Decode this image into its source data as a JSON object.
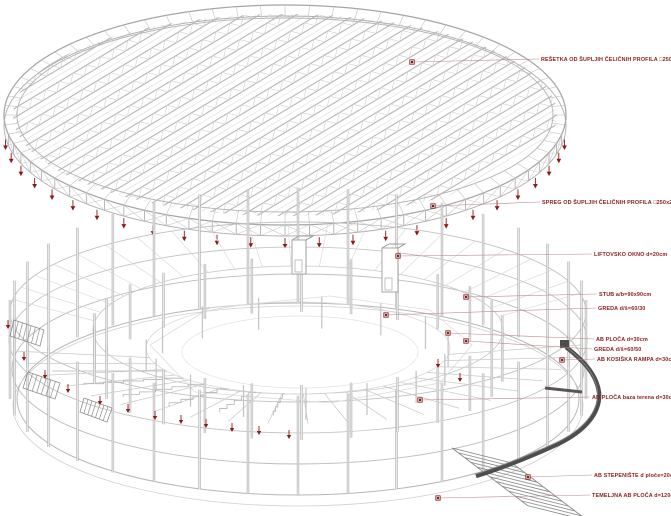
{
  "figure": {
    "type": "structural-axonometric-diagram",
    "subject": "stadium exploded structural view",
    "upper_part": "steel roof truss grid (elliptical)",
    "lower_part": "reinforced concrete stadium bowl frame"
  },
  "colors": {
    "background": "#ffffff",
    "line_light": "#d2d2d2",
    "line_mid": "#b9b9b9",
    "line_rim": "#a5a5a5",
    "line_col": "#aaaaaa",
    "annotation_red": "#8b1a1a",
    "marker_fill": "#f0dada",
    "ramp_dark": "#4d4d4d",
    "stair_gray": "#9b9b9b",
    "hatch_gray": "#8e8e8e"
  },
  "annotations": [
    {
      "id": "resetka",
      "text": "REŠETKA OD ŠUPLJIH ČELIČNIH PROFILA □250x250mm",
      "label_x": 541,
      "label_y": 61,
      "marker_x": 412,
      "marker_y": 62
    },
    {
      "id": "spreg",
      "text": "SPREG OD ŠUPLJIH ČELIČNIH PROFILA □250x250mm",
      "label_x": 542,
      "label_y": 204,
      "marker_x": 433,
      "marker_y": 206
    },
    {
      "id": "liftovsko-okno",
      "text": "LIFTOVSKO OKNO d=20cm",
      "label_x": 594,
      "label_y": 256,
      "marker_x": 398,
      "marker_y": 256
    },
    {
      "id": "stub",
      "text": "STUB a/b=90x90cm",
      "label_x": 599,
      "label_y": 296,
      "marker_x": 466,
      "marker_y": 297
    },
    {
      "id": "greda-60-30",
      "text": "GREDA d/š=60/30",
      "label_x": 598,
      "label_y": 310,
      "marker_x": 386,
      "marker_y": 315
    },
    {
      "id": "ab-ploca",
      "text": "AB PLOČA d=30cm",
      "label_x": 596,
      "label_y": 341,
      "marker_x": 448,
      "marker_y": 333
    },
    {
      "id": "greda-60-50",
      "text": "GREDA d/š=60/50",
      "label_x": 594,
      "label_y": 351,
      "marker_x": 466,
      "marker_y": 341
    },
    {
      "id": "ab-kosiska-rampa",
      "text": "AB KOSIŠKA RAMPA d=30cm",
      "label_x": 597,
      "label_y": 361,
      "marker_x": 562,
      "marker_y": 360
    },
    {
      "id": "ab-ploca-baza",
      "text": "AB PLOČA baza terena d=30cm",
      "label_x": 592,
      "label_y": 399,
      "marker_x": 420,
      "marker_y": 400
    },
    {
      "id": "ab-stepeniste",
      "text": "AB STEPENIŠTE  d ploče=20cm",
      "label_x": 594,
      "label_y": 477,
      "marker_x": 528,
      "marker_y": 477
    },
    {
      "id": "temeljna-ploca",
      "text": "TEMELJNA AB PLOČA d=120cm",
      "label_x": 592,
      "label_y": 497,
      "marker_x": 438,
      "marker_y": 498
    }
  ],
  "load_arrows": {
    "roof_count": 25,
    "bowl_points": [
      [
        8,
        320
      ],
      [
        24,
        352
      ],
      [
        45,
        370
      ],
      [
        68,
        384
      ],
      [
        100,
        396
      ],
      [
        128,
        404
      ],
      [
        155,
        411
      ],
      [
        181,
        415
      ],
      [
        206,
        419
      ],
      [
        232,
        423
      ],
      [
        259,
        426
      ],
      [
        289,
        430
      ],
      [
        438,
        359
      ],
      [
        460,
        373
      ]
    ]
  }
}
